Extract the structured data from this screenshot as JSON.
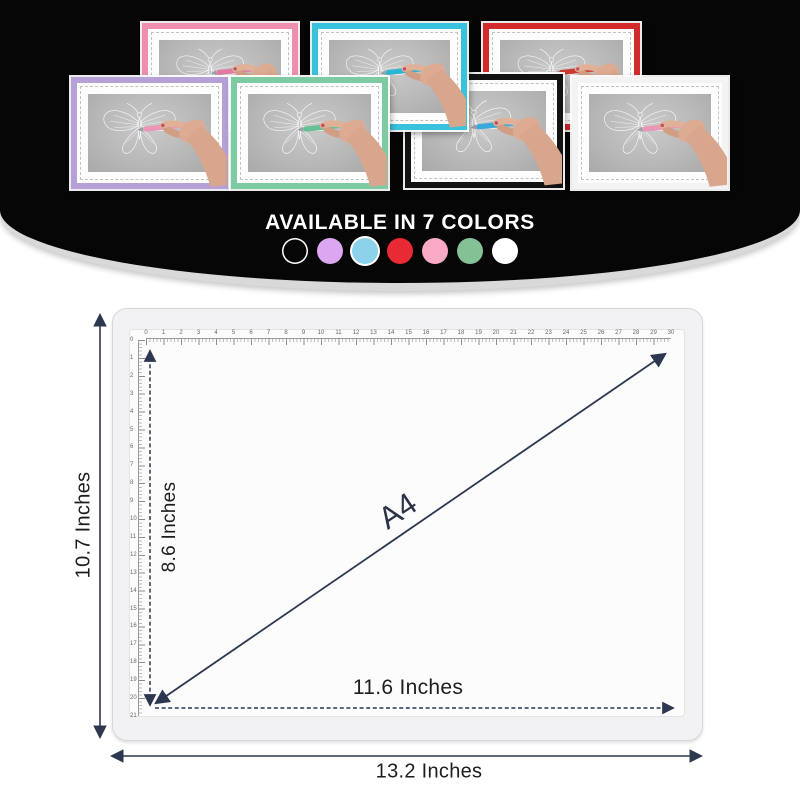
{
  "header": {
    "title": "AVAILABLE IN 7 COLORS",
    "pads": [
      {
        "name": "pink",
        "frame": "#ef8fb0",
        "pen": "#e27ba4"
      },
      {
        "name": "teal",
        "frame": "#39c2dd",
        "pen": "#29b6d6"
      },
      {
        "name": "red",
        "frame": "#d32a2b",
        "pen": "#cd3a32"
      },
      {
        "name": "purple",
        "frame": "#b5a0d8",
        "pen": "#ea96b6"
      },
      {
        "name": "green",
        "frame": "#7ecaa3",
        "pen": "#66bf95"
      },
      {
        "name": "black",
        "frame": "#121212",
        "pen": "#38a9da"
      },
      {
        "name": "white",
        "frame": "#f3f3f3",
        "pen": "#ea96b6"
      }
    ],
    "swatches": [
      {
        "name": "black",
        "fill": "transparent",
        "ring": "#ffffff"
      },
      {
        "name": "purple",
        "fill": "#dca7f0"
      },
      {
        "name": "blue",
        "fill": "#8bd2ea",
        "ring": "#ffffff"
      },
      {
        "name": "red",
        "fill": "#e72a33"
      },
      {
        "name": "pink",
        "fill": "#f9aac6"
      },
      {
        "name": "green",
        "fill": "#84c296"
      },
      {
        "name": "white",
        "fill": "#ffffff"
      }
    ]
  },
  "diagram": {
    "labels": {
      "outer_height": "10.7 Inches",
      "outer_width": "13.2 Inches",
      "inner_height": "8.6 Inches",
      "inner_width": "11.6 Inches",
      "diagonal": "A4"
    },
    "arrow_color": "#2e3750",
    "top_ruler_numbers": [
      0,
      1,
      2,
      3,
      4,
      5,
      6,
      7,
      8,
      9,
      10,
      11,
      12,
      13,
      14,
      15,
      16,
      17,
      18,
      19,
      20,
      21,
      22,
      23,
      24,
      25,
      26,
      27,
      28,
      29,
      30
    ],
    "left_ruler_numbers": [
      0,
      1,
      2,
      3,
      4,
      5,
      6,
      7,
      8,
      9,
      10,
      11,
      12,
      13,
      14,
      15,
      16,
      17,
      18,
      19,
      20,
      21
    ]
  }
}
